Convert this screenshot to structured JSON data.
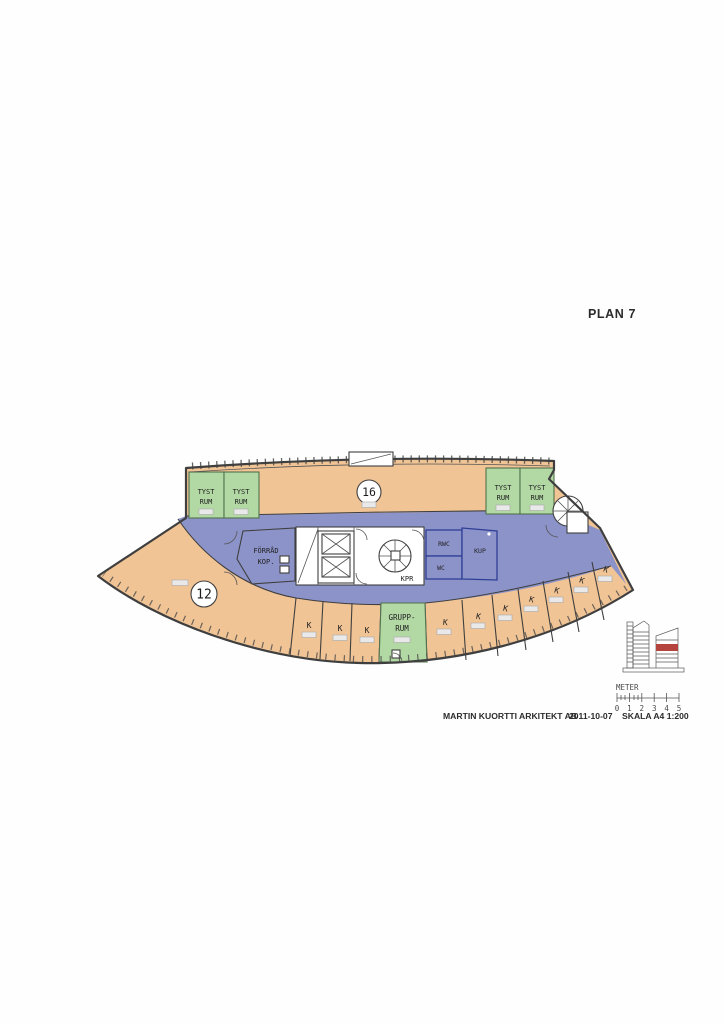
{
  "colors": {
    "room_orange": "#f1c495",
    "room_green": "#b2d8a4",
    "corridor_blue": "#8c93c9",
    "core_stroke_blue": "#2f3f96",
    "wall_gray": "#3f3f3f",
    "section_marker_red": "#b5443f"
  },
  "page": {
    "title": "PLAN 7",
    "footer": {
      "firm": "MARTIN KUORTTI ARKITEKT AB",
      "date": "2011-10-07",
      "scale": "SKALA A4 1:200"
    },
    "scale_bar": {
      "label": "METER",
      "ticks": [
        "0",
        "1",
        "2",
        "3",
        "4",
        "5"
      ]
    }
  },
  "plan": {
    "zones": [
      {
        "number": "16"
      },
      {
        "number": "12"
      }
    ],
    "quiet_rooms": [
      {
        "line1": "TYST",
        "line2": "RUM"
      },
      {
        "line1": "TYST",
        "line2": "RUM"
      },
      {
        "line1": "TYST",
        "line2": "RUM"
      },
      {
        "line1": "TYST",
        "line2": "RUM"
      }
    ],
    "group_room": {
      "line1": "GRUPP-",
      "line2": "RUM"
    },
    "k_rooms": [
      "K",
      "K",
      "K",
      "K",
      "K",
      "K",
      "K",
      "K",
      "K",
      "K"
    ],
    "core": {
      "forrad": "FÖRRÅD",
      "kop": "KOP.",
      "kpr": "KPR",
      "rwc": "RWC",
      "wc": "WC",
      "kup": "KUP"
    }
  }
}
